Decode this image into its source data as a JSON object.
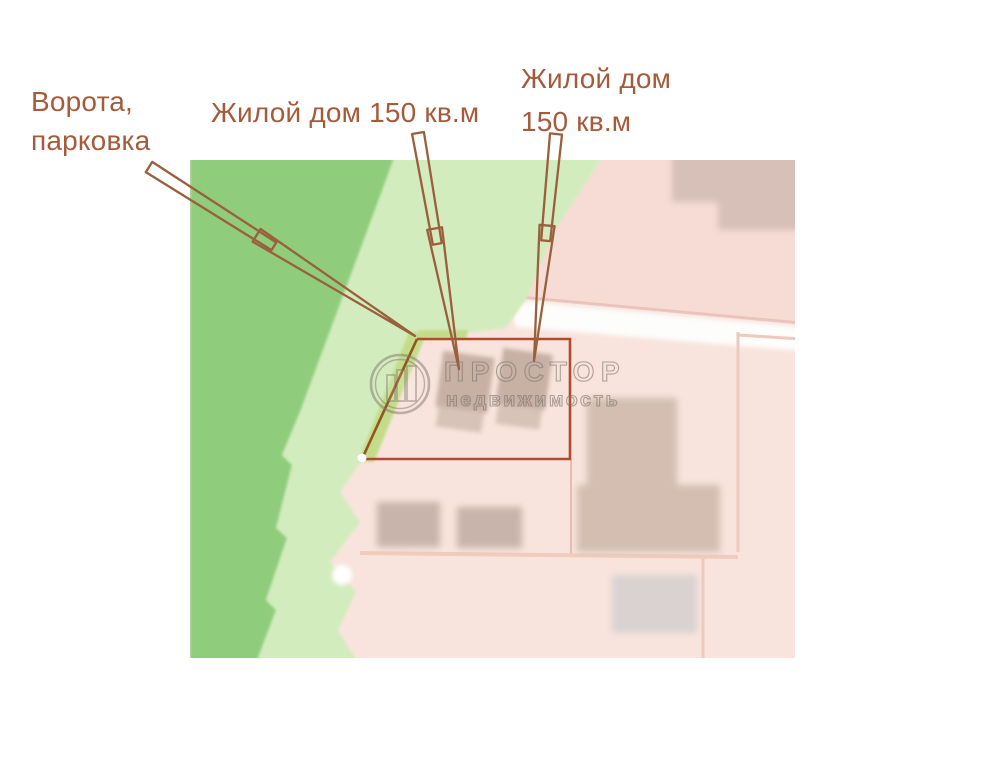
{
  "annotations": {
    "gate_label": {
      "line1": "Ворота,",
      "line2": "парковка"
    },
    "house_center_label": "Жилой дом 150 кв.м",
    "house_right_label": {
      "line1": "Жилой дом",
      "line2": "150 кв.м"
    }
  },
  "watermark": {
    "brand": "ПРОСТОР",
    "subtitle": "недвижимость"
  },
  "colors": {
    "annotation_text": "#a45a3b",
    "annotation_arrow": "#9a5f3d",
    "boundary_red": "#b34a2e",
    "boundary_slant": "#93551f",
    "green_dark": "#8fcd7c",
    "green_light": "#d3ecbd",
    "green_strip": "#c3dc8a",
    "pink_base": "#f8e4dc",
    "pink_parcel": "#f6dcd4",
    "pink_line": "#eac2ba",
    "salmon_line": "#edcabd",
    "building_tan_dark": "#c9b0a5",
    "building_tan_light": "#d8c3b8",
    "building_mauve": "#d7c0b8",
    "building_gray": "#d9d2d0",
    "building_blur": "#c9b4ab",
    "big_building": "#d4beb2",
    "road_white": "#fdfdfb",
    "watermark_gray": "rgba(125,116,108,0.5)"
  }
}
